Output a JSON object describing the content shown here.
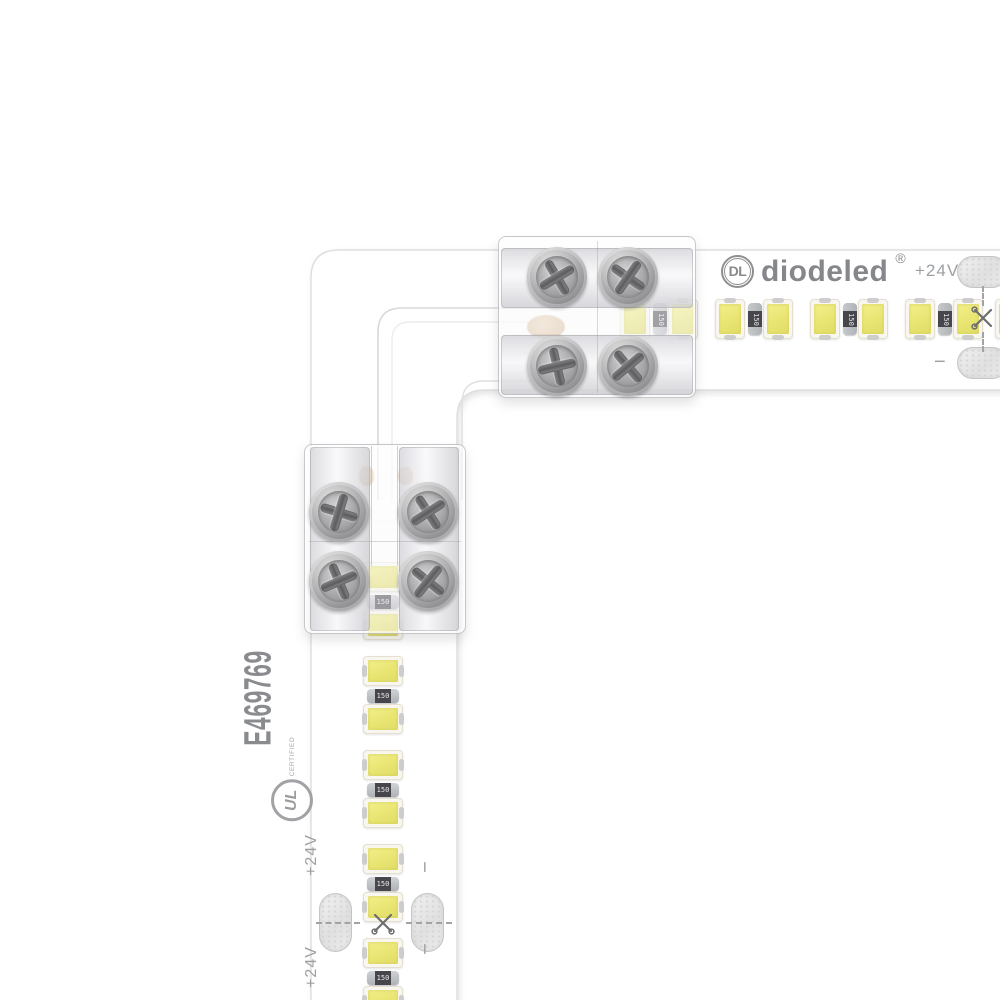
{
  "scene": {
    "type": "product-photo",
    "subject": "White LED tape light joined at a 90-degree corner with two clear screw-down terminal connectors and an L-shaped corner connector",
    "background": "#ffffff"
  },
  "brand": {
    "monogram": "DL",
    "name": "diodeled",
    "registered_mark": "®"
  },
  "certification": {
    "ul_file_number": "E469769",
    "ul_monogram": "UL",
    "ul_certified_text": "CERTIFIED"
  },
  "electrical": {
    "voltage_label": "+24V",
    "negative_label": "−",
    "resistor_marking": "150"
  },
  "strips": {
    "horizontal": {
      "visible_led_modules": 4,
      "leds_per_module": 2,
      "solder_pads": 2,
      "cut_marks": 1,
      "voltage_labels": 1,
      "negative_labels": 1
    },
    "vertical": {
      "visible_led_modules": 5,
      "leds_per_module": 2,
      "solder_pads": 2,
      "cut_marks": 1,
      "voltage_labels": 2,
      "negative_labels": 2
    }
  },
  "connectors": {
    "count": 2,
    "screws_each": 4,
    "style": "clear screw-down terminal"
  },
  "colors": {
    "led_phosphor": "#e9e573",
    "led_package": "#f8f6ee",
    "pcb": "#ffffff",
    "silkscreen_gray": "#8f9193",
    "resistor_body": "#46464c",
    "metal": "#b9bcc0",
    "copper": "#c9a06b"
  }
}
